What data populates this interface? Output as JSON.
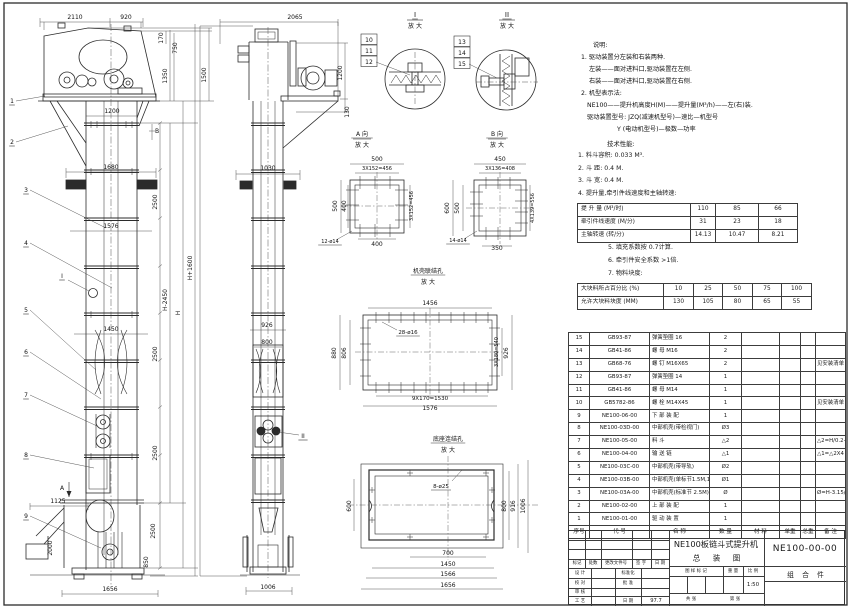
{
  "meta": {
    "sheet_bg": "#ffffff",
    "line_color": "#2b2b2b",
    "accent": "#3c3c3c"
  },
  "notes": {
    "heading": "说明:",
    "items": [
      {
        "t": "1. 驱动装置分左装和右装两种."
      },
      {
        "t": "左装——面对进料口,驱动装置在左侧."
      },
      {
        "t": "右装——面对进料口,驱动装置在右侧."
      },
      {
        "t": "2. 机型表示法:"
      },
      {
        "t": "NE100——提升机高度H(M)——提升量(M³/h)——左(右)装."
      },
      {
        "t": "驱动装置型号: JZQ(减速机型号)—速比—机型号"
      },
      {
        "t": "Y (电动机型号)—极数—功率"
      }
    ],
    "tech_heading": "技术性能:",
    "tech_items": [
      {
        "t": "1. 料斗容积: 0.033 M³."
      },
      {
        "t": "2. 斗  距: 0.4 M."
      },
      {
        "t": "3. 斗  宽: 0.4 M."
      },
      {
        "t": "4. 提升量,牵引件线速度和主轴转速:"
      }
    ],
    "tech_items2": [
      {
        "t": "5. 填充系数按 0.7计算."
      },
      {
        "t": "6. 牵引件安全系数 >1倍."
      },
      {
        "t": "7. 物料块度:"
      }
    ]
  },
  "capacity_table": {
    "rows": [
      {
        "label": "提 升 量  (M³/时)",
        "v1": "110",
        "v2": "85",
        "v3": "66"
      },
      {
        "label": "牵引件线速度 (M/分)",
        "v1": "31",
        "v2": "23",
        "v3": "18"
      },
      {
        "label": "主轴转速  (转/分)",
        "v1": "14.13",
        "v2": "10.47",
        "v3": "8.21"
      }
    ]
  },
  "lump_table": {
    "rows": [
      {
        "label": "大块料所占百分比 (%)",
        "v1": "10",
        "v2": "25",
        "v3": "50",
        "v4": "75",
        "v5": "100"
      },
      {
        "label": "允许大块料块度 (MM)",
        "v1": "130",
        "v2": "105",
        "v3": "80",
        "v4": "65",
        "v5": "55"
      }
    ]
  },
  "bom": {
    "headers": {
      "idx": "序号",
      "code": "代  号",
      "name": "名  称",
      "qty": "数 量",
      "mat": "材  料",
      "unitw": "单重",
      "totw": "总重",
      "remark": "备  注"
    },
    "rows": [
      {
        "idx": "15",
        "code": "GB93-87",
        "name": "弹簧垫圈 16",
        "qty": "2",
        "mat": "",
        "unitw": "",
        "totw": "",
        "remark": ""
      },
      {
        "idx": "14",
        "code": "GB41-86",
        "name": "螺 母  M16",
        "qty": "2",
        "mat": "",
        "unitw": "",
        "totw": "",
        "remark": ""
      },
      {
        "idx": "13",
        "code": "GB68-76",
        "name": "螺 钉  M16X65",
        "qty": "2",
        "mat": "",
        "unitw": "",
        "totw": "",
        "remark": "见安装清单"
      },
      {
        "idx": "12",
        "code": "GB93-87",
        "name": "弹簧垫圈 14",
        "qty": "1",
        "mat": "",
        "unitw": "",
        "totw": "",
        "remark": ""
      },
      {
        "idx": "11",
        "code": "GB41-86",
        "name": "螺 母  M14",
        "qty": "1",
        "mat": "",
        "unitw": "",
        "totw": "",
        "remark": ""
      },
      {
        "idx": "10",
        "code": "GB5782-86",
        "name": "螺 栓  M14X45",
        "qty": "1",
        "mat": "",
        "unitw": "",
        "totw": "",
        "remark": "见安装清单"
      },
      {
        "idx": "9",
        "code": "NE100-06-00",
        "name": "下 部 装 配",
        "qty": "1",
        "mat": "",
        "unitw": "",
        "totw": "",
        "remark": ""
      },
      {
        "idx": "8",
        "code": "NE100-03D-00",
        "name": "中部机壳(带检视门)",
        "qty": "Ø3",
        "mat": "",
        "unitw": "",
        "totw": "",
        "remark": ""
      },
      {
        "idx": "7",
        "code": "NE100-05-00",
        "name": "料  斗",
        "qty": "△2",
        "mat": "",
        "unitw": "",
        "totw": "",
        "remark": "△2=H/0.2+5.75"
      },
      {
        "idx": "6",
        "code": "NE100-04-00",
        "name": "输 送 链",
        "qty": "△1",
        "mat": "",
        "unitw": "",
        "totw": "",
        "remark": "△1=△2X4"
      },
      {
        "idx": "5",
        "code": "NE100-03C-00",
        "name": "中部机壳(带导轨)",
        "qty": "Ø2",
        "mat": "",
        "unitw": "",
        "totw": "",
        "remark": ""
      },
      {
        "idx": "4",
        "code": "NE100-03B-00",
        "name": "中部机壳(单标节1.5M,1M)",
        "qty": "Ø1",
        "mat": "",
        "unitw": "",
        "totw": "",
        "remark": ""
      },
      {
        "idx": "3",
        "code": "NE100-03A-00",
        "name": "中部机壳(标准节 2.5M)",
        "qty": "Ø",
        "mat": "",
        "unitw": "",
        "totw": "",
        "remark": "Ø=H-3.15/2.5"
      },
      {
        "idx": "2",
        "code": "NE100-02-00",
        "name": "上 部 装 配",
        "qty": "1",
        "mat": "",
        "unitw": "",
        "totw": "",
        "remark": ""
      },
      {
        "idx": "1",
        "code": "NE100-01-00",
        "name": "驱 动 装 置",
        "qty": "1",
        "mat": "",
        "unitw": "",
        "totw": "",
        "remark": ""
      }
    ]
  },
  "titleblock": {
    "title_line1": "NE100板链斗式提升机",
    "title_line2": "总 装 图",
    "drawing_no": "NE100-00-00",
    "part_class": "组 合 件",
    "rev": {
      "mark": "标记",
      "count": "处数",
      "doc": "更改文件号",
      "sign": "签 字",
      "date": "日 期"
    },
    "fields": {
      "design": "设 计",
      "std": "标准化",
      "check": "校 对",
      "approve": "批 准",
      "review": "审 核",
      "craft": "工 艺",
      "date_label": "日 期",
      "date_value": "97.7"
    },
    "stamp": {
      "mark_label": "图 样 标 记",
      "weight_label": "重 量",
      "scale_label": "比 例",
      "scale_value": "1:50",
      "sheets": "共  张",
      "sheet_no": "第  张"
    }
  },
  "views": {
    "labels": [
      {
        "t": "2110",
        "x": 75,
        "y": 19
      },
      {
        "t": "920",
        "x": 126,
        "y": 19
      },
      {
        "t": "170",
        "x": 163,
        "y": 38,
        "r": 1
      },
      {
        "t": "750",
        "x": 177,
        "y": 48,
        "r": 1
      },
      {
        "t": "1350",
        "x": 167,
        "y": 76,
        "r": 1
      },
      {
        "t": "1500",
        "x": 206,
        "y": 75,
        "r": 1
      },
      {
        "t": "1200",
        "x": 112,
        "y": 113
      },
      {
        "t": "B",
        "x": 157,
        "y": 133
      },
      {
        "t": "1680",
        "x": 111,
        "y": 169
      },
      {
        "t": "2500",
        "x": 157,
        "y": 202,
        "r": 1
      },
      {
        "t": "1576",
        "x": 111,
        "y": 228
      },
      {
        "t": "H-2450",
        "x": 167,
        "y": 300,
        "r": 1
      },
      {
        "t": "H",
        "x": 180,
        "y": 313,
        "r": 1
      },
      {
        "t": "H+1600",
        "x": 192,
        "y": 268,
        "r": 1
      },
      {
        "t": "1450",
        "x": 111,
        "y": 331
      },
      {
        "t": "2500",
        "x": 157,
        "y": 354,
        "r": 1
      },
      {
        "t": "2500",
        "x": 157,
        "y": 453,
        "r": 1
      },
      {
        "t": "2500",
        "x": 155,
        "y": 531,
        "r": 1
      },
      {
        "t": "1125",
        "x": 58,
        "y": 503
      },
      {
        "t": "A",
        "x": 62,
        "y": 490
      },
      {
        "t": "2000",
        "x": 52,
        "y": 548,
        "r": 1
      },
      {
        "t": "850",
        "x": 148,
        "y": 562,
        "r": 1
      },
      {
        "t": "1656",
        "x": 110,
        "y": 591
      },
      {
        "t": "I",
        "x": 62,
        "y": 278,
        "u": 1
      },
      {
        "t": "1",
        "x": 12,
        "y": 103,
        "u": 1
      },
      {
        "t": "2",
        "x": 12,
        "y": 144,
        "u": 1
      },
      {
        "t": "3",
        "x": 26,
        "y": 192,
        "u": 1
      },
      {
        "t": "4",
        "x": 26,
        "y": 245,
        "u": 1
      },
      {
        "t": "5",
        "x": 26,
        "y": 312,
        "u": 1
      },
      {
        "t": "6",
        "x": 26,
        "y": 354,
        "u": 1
      },
      {
        "t": "7",
        "x": 26,
        "y": 397,
        "u": 1
      },
      {
        "t": "8",
        "x": 26,
        "y": 457,
        "u": 1
      },
      {
        "t": "9",
        "x": 26,
        "y": 518,
        "u": 1
      },
      {
        "t": "2065",
        "x": 295,
        "y": 19
      },
      {
        "t": "1200",
        "x": 342,
        "y": 73,
        "r": 1
      },
      {
        "t": "130",
        "x": 349,
        "y": 112,
        "r": 1
      },
      {
        "t": "1030",
        "x": 268,
        "y": 170
      },
      {
        "t": "926",
        "x": 267,
        "y": 327
      },
      {
        "t": "800",
        "x": 267,
        "y": 344
      },
      {
        "t": "1006",
        "x": 268,
        "y": 589
      },
      {
        "t": "II",
        "x": 303,
        "y": 438,
        "u": 1
      },
      {
        "t": "10",
        "x": 369,
        "y": 42,
        "b": 1
      },
      {
        "t": "11",
        "x": 369,
        "y": 53,
        "b": 1
      },
      {
        "t": "12",
        "x": 369,
        "y": 64,
        "b": 1
      },
      {
        "t": "13",
        "x": 462,
        "y": 44,
        "b": 1
      },
      {
        "t": "14",
        "x": 462,
        "y": 55,
        "b": 1
      },
      {
        "t": "15",
        "x": 462,
        "y": 66,
        "b": 1
      },
      {
        "t": "I",
        "x": 415,
        "y": 17,
        "fs": 7,
        "u": 1
      },
      {
        "t": "放 大",
        "x": 415,
        "y": 28
      },
      {
        "t": "II",
        "x": 507,
        "y": 17,
        "fs": 7,
        "u": 1
      },
      {
        "t": "放 大",
        "x": 507,
        "y": 28
      },
      {
        "t": "A 向",
        "x": 362,
        "y": 136,
        "u": 1
      },
      {
        "t": "放 大",
        "x": 362,
        "y": 147
      },
      {
        "t": "B 向",
        "x": 497,
        "y": 136,
        "u": 1
      },
      {
        "t": "放 大",
        "x": 497,
        "y": 147
      },
      {
        "t": "500",
        "x": 377,
        "y": 161
      },
      {
        "t": "3X152=456",
        "x": 377,
        "y": 170,
        "fs": 5
      },
      {
        "t": "500",
        "x": 337,
        "y": 206,
        "r": 1
      },
      {
        "t": "400",
        "x": 346,
        "y": 206,
        "r": 1
      },
      {
        "t": "3X152=456",
        "x": 413,
        "y": 206,
        "r": 1,
        "fs": 5
      },
      {
        "t": "400",
        "x": 377,
        "y": 246
      },
      {
        "t": "12-ø14",
        "x": 330,
        "y": 243,
        "fs": 5,
        "u": 1
      },
      {
        "t": "450",
        "x": 500,
        "y": 161
      },
      {
        "t": "3X136=408",
        "x": 500,
        "y": 170,
        "fs": 5
      },
      {
        "t": "600",
        "x": 449,
        "y": 208,
        "r": 1
      },
      {
        "t": "500",
        "x": 459,
        "y": 208,
        "r": 1
      },
      {
        "t": "4X139=556",
        "x": 534,
        "y": 208,
        "r": 1,
        "fs": 5
      },
      {
        "t": "14-ø14",
        "x": 458,
        "y": 242,
        "fs": 5,
        "u": 1
      },
      {
        "t": "350",
        "x": 497,
        "y": 250
      },
      {
        "t": "机壳联结孔",
        "x": 428,
        "y": 273,
        "u": 1
      },
      {
        "t": "放 大",
        "x": 428,
        "y": 284
      },
      {
        "t": "1456",
        "x": 430,
        "y": 305
      },
      {
        "t": "880",
        "x": 336,
        "y": 353,
        "r": 1
      },
      {
        "t": "806",
        "x": 346,
        "y": 353,
        "r": 1
      },
      {
        "t": "28-ø16",
        "x": 408,
        "y": 334,
        "fs": 5.5,
        "u": 1
      },
      {
        "t": "3X180=540",
        "x": 498,
        "y": 352,
        "r": 1,
        "fs": 5
      },
      {
        "t": "926",
        "x": 508,
        "y": 353,
        "r": 1
      },
      {
        "t": "9X170=1530",
        "x": 430,
        "y": 400,
        "fs": 5.5
      },
      {
        "t": "1576",
        "x": 430,
        "y": 410
      },
      {
        "t": "底座连结孔",
        "x": 448,
        "y": 441,
        "u": 1
      },
      {
        "t": "放 大",
        "x": 448,
        "y": 452
      },
      {
        "t": "8-ø25",
        "x": 441,
        "y": 488,
        "fs": 5.5,
        "u": 1
      },
      {
        "t": "600",
        "x": 351,
        "y": 506,
        "r": 1
      },
      {
        "t": "800",
        "x": 506,
        "y": 506,
        "r": 1
      },
      {
        "t": "916",
        "x": 515,
        "y": 506,
        "r": 1
      },
      {
        "t": "1006",
        "x": 525,
        "y": 506,
        "r": 1
      },
      {
        "t": "700",
        "x": 448,
        "y": 555
      },
      {
        "t": "1450",
        "x": 448,
        "y": 566
      },
      {
        "t": "1566",
        "x": 448,
        "y": 576
      },
      {
        "t": "1656",
        "x": 448,
        "y": 587
      }
    ]
  }
}
